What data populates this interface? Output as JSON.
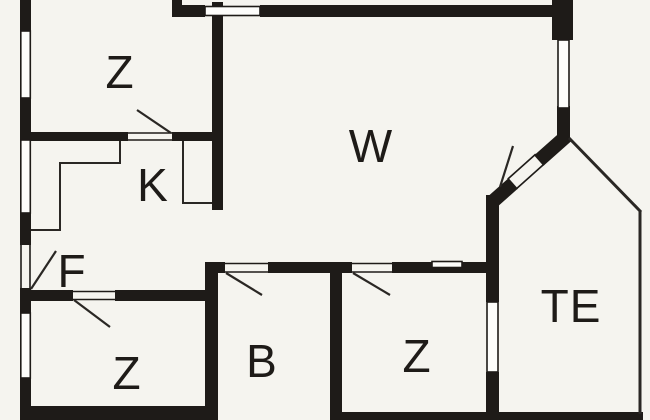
{
  "title": "Apartment floor plan",
  "colors": {
    "background": "#f5f4ef",
    "wall": "#1e1b18",
    "window_fill": "#fdfdfb"
  },
  "rooms": [
    {
      "id": "z-top-left",
      "label": "Z"
    },
    {
      "id": "w-living",
      "label": "W"
    },
    {
      "id": "k-kitchen",
      "label": "K"
    },
    {
      "id": "f-hall",
      "label": "F"
    },
    {
      "id": "z-bottom-left",
      "label": "Z"
    },
    {
      "id": "b-bath",
      "label": "B"
    },
    {
      "id": "z-bottom-right",
      "label": "Z"
    },
    {
      "id": "te-terrace",
      "label": "TE"
    }
  ]
}
